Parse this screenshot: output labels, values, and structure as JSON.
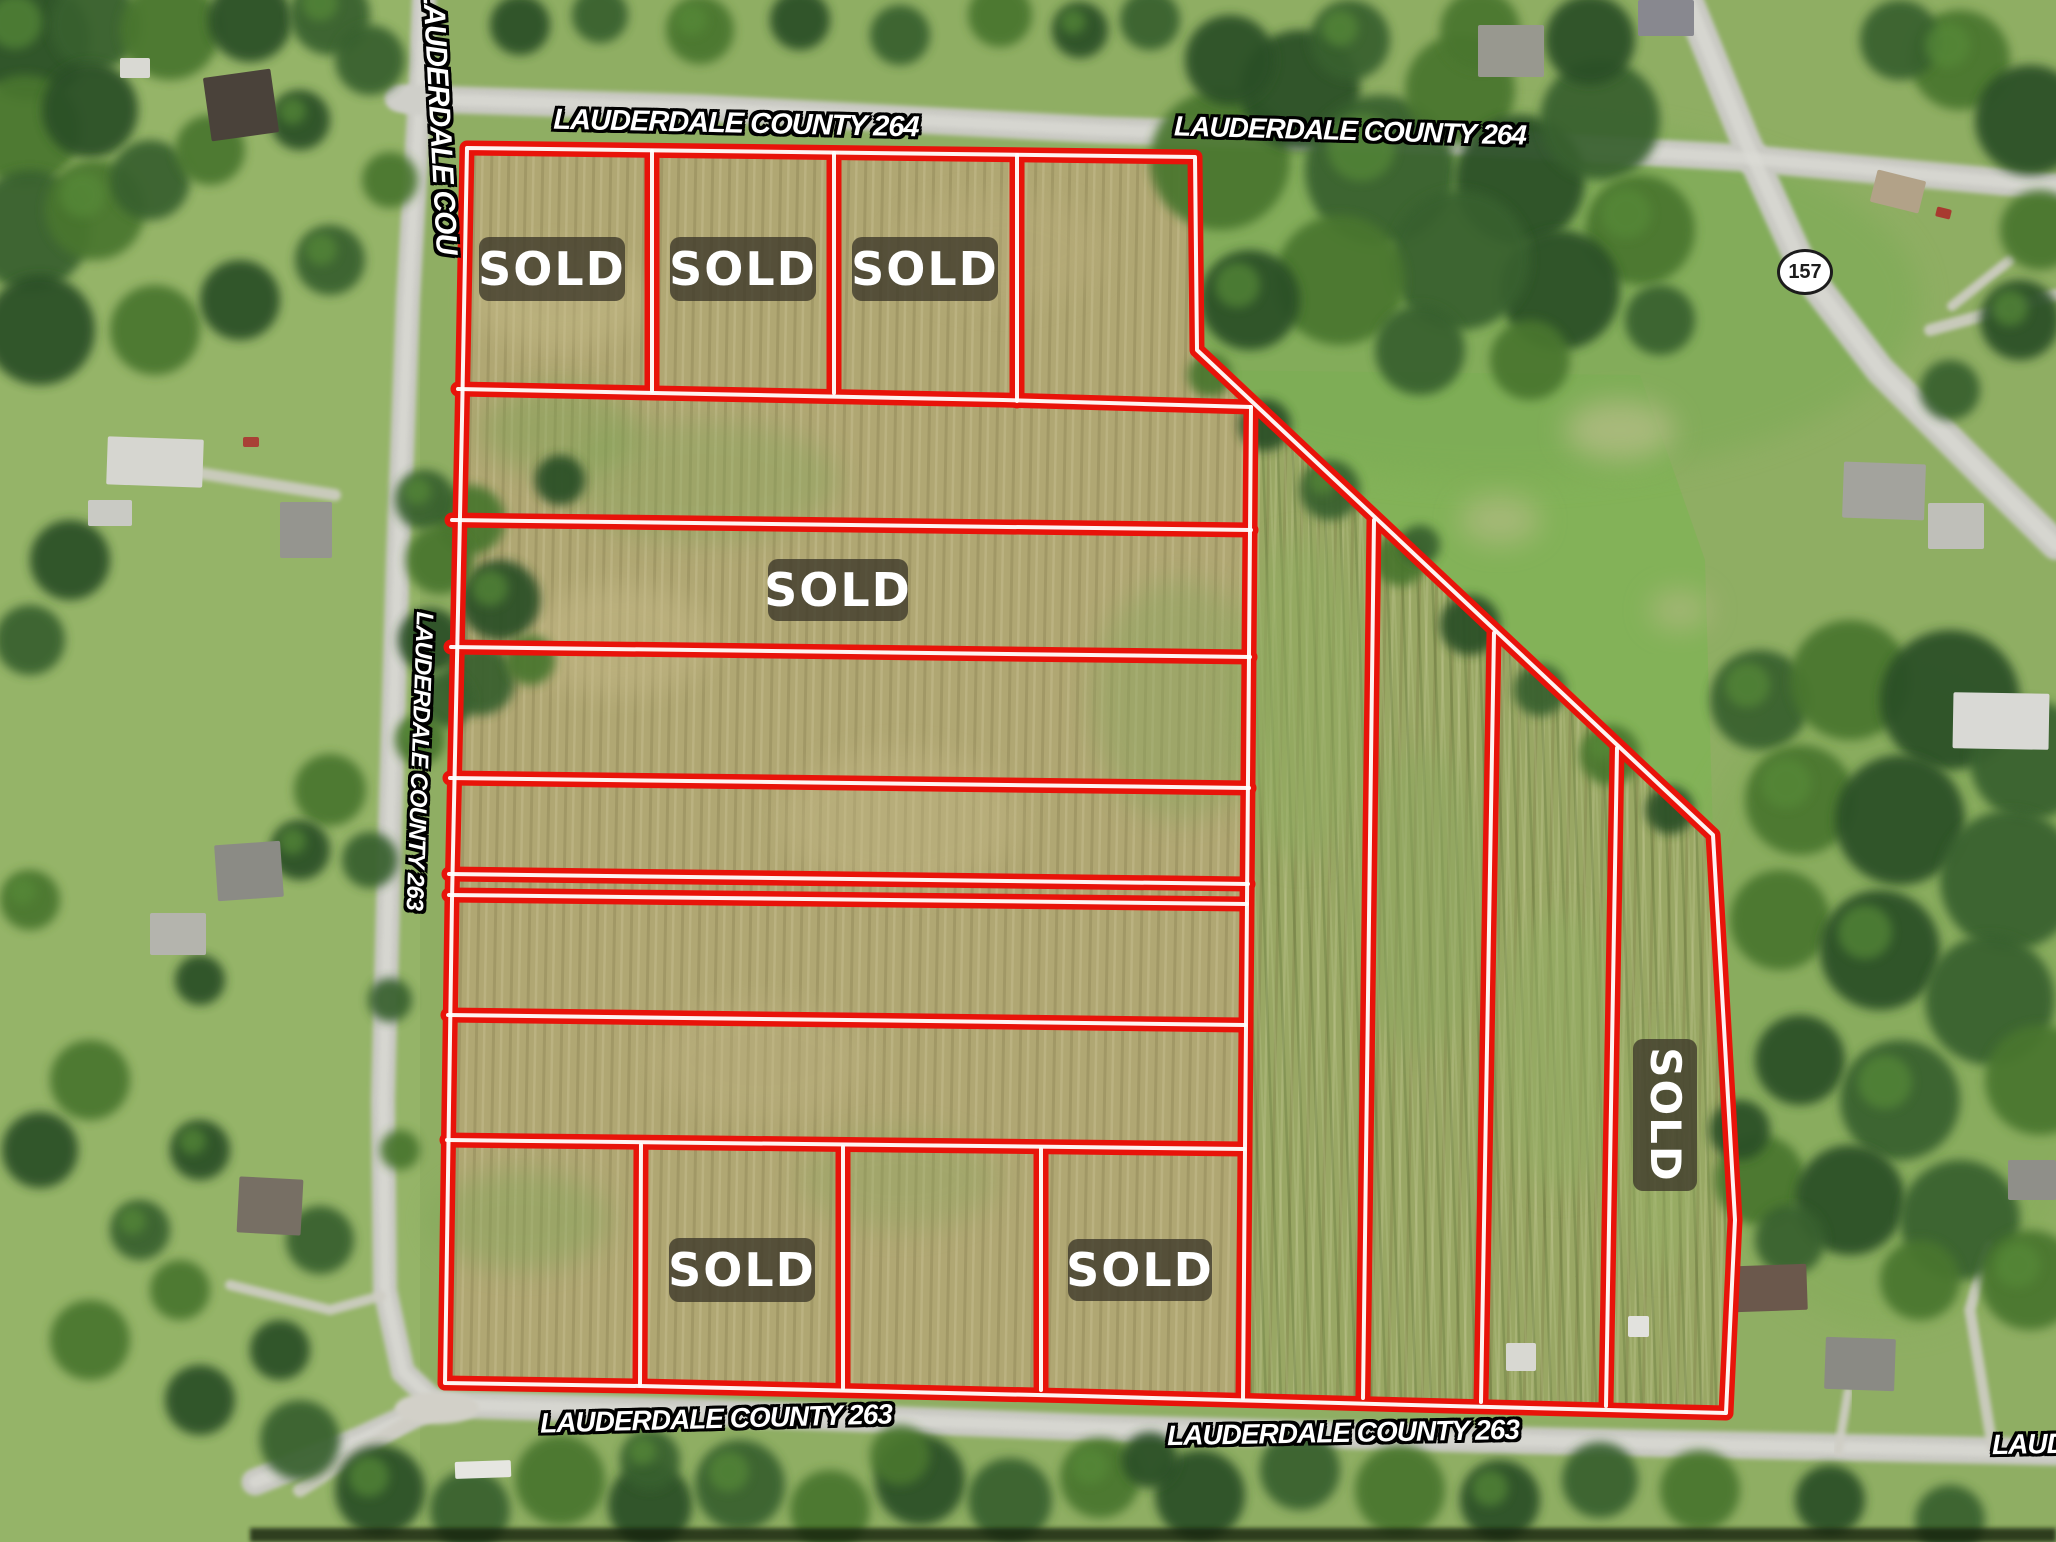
{
  "road_labels": [
    {
      "name": "county-264-top-west",
      "text": "LAUDERDALE COUNTY 264"
    },
    {
      "name": "county-264-top-east",
      "text": "LAUDERDALE COUNTY 264"
    },
    {
      "name": "county-road-left-vertical-top",
      "text": "LAUDERDALE COU"
    },
    {
      "name": "county-263-left-vertical",
      "text": "LAUDERDALE COUNTY 263"
    },
    {
      "name": "county-263-bottom-west",
      "text": "LAUDERDALE COUNTY 263"
    },
    {
      "name": "county-263-bottom-east",
      "text": "LAUDERDALE COUNTY 263"
    },
    {
      "name": "county-263-bottom-right-partial",
      "text": "LAUDERDALE COUNTY 263"
    }
  ],
  "highway_shield": {
    "route": "157"
  },
  "sold_labels": [
    {
      "location": "top-row-lot-1",
      "text": "SOLD"
    },
    {
      "location": "top-row-lot-2",
      "text": "SOLD"
    },
    {
      "location": "top-row-lot-3",
      "text": "SOLD"
    },
    {
      "location": "middle-strip",
      "text": "SOLD"
    },
    {
      "location": "bottom-row-lot-2",
      "text": "SOLD"
    },
    {
      "location": "bottom-row-lot-4",
      "text": "SOLD"
    },
    {
      "location": "right-column-strip",
      "text": "SOLD"
    }
  ],
  "colors": {
    "parcel_boundary_red": "#e8130a",
    "boundary_core_white": "#ffffff",
    "sold_badge_bg": "rgba(62,58,42,0.8)",
    "sold_badge_text": "#ffffff",
    "road_label_fill": "#ffffff",
    "road_label_outline": "#000000",
    "shield_fill": "#ffffff",
    "shield_border": "#1c1c1c"
  }
}
